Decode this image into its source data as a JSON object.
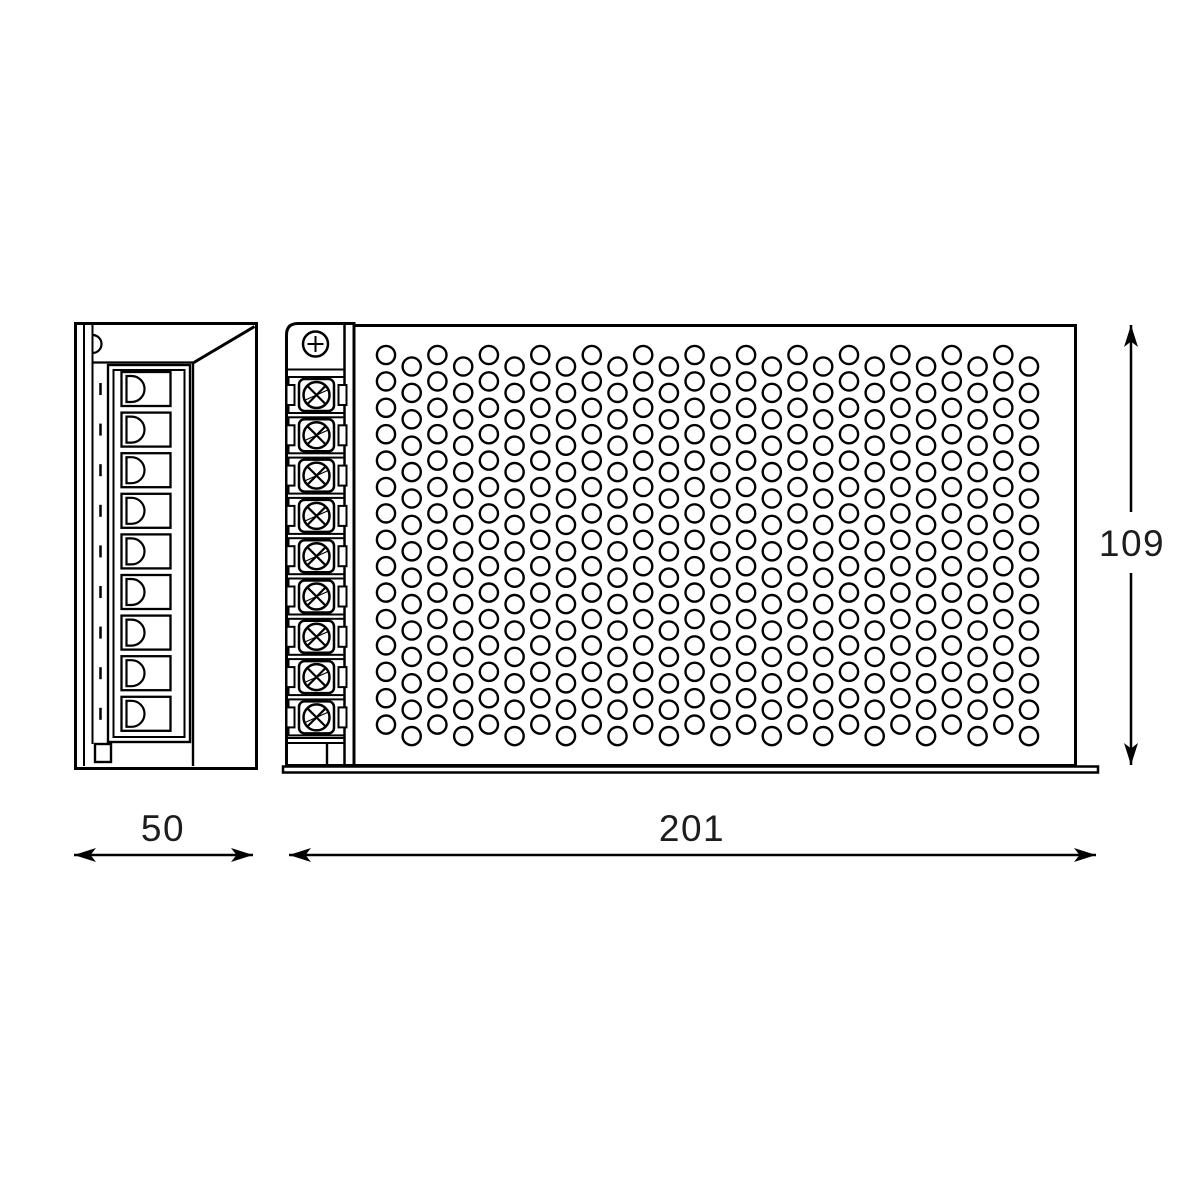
{
  "drawing_title": "power-supply-dimension-drawing",
  "dimension_labels": {
    "side_width": "50",
    "front_width": "201",
    "front_height": "109"
  },
  "side_view": {
    "slot_count": 9,
    "description": "side profile with terminal connector slots"
  },
  "front_view": {
    "terminal_count": 9,
    "top_screw": "phillips-plus-screw",
    "perforation": {
      "columns": 26,
      "rows": 15,
      "pattern": "staggered"
    }
  },
  "colors": {
    "line": "#000000",
    "text": "#1d1d1f",
    "background": "#ffffff"
  }
}
